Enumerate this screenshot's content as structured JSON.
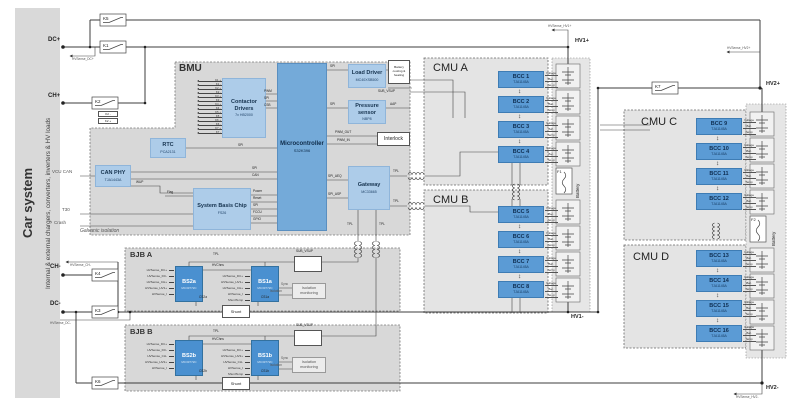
{
  "sidebar": {
    "title": "Car system",
    "subtitle": "Internal & external chargers, converters, inverters & HV loads"
  },
  "rails": {
    "dc_plus": "DC+",
    "ch_plus": "CH+",
    "ch_minus": "CH-",
    "dc_minus": "DC-",
    "hv1_plus": "HV1+",
    "hv1_minus": "HV1-",
    "hv2_plus": "HV2+",
    "hv2_minus": "HV2-"
  },
  "sense": {
    "dc_plus": "HVSense_DC+",
    "ch_minus": "HVSense_CH-",
    "dc_minus": "HVSense_DC-",
    "hv1_plus": "HVSense_HV1+",
    "hv2_plus": "HVSense_HV2+",
    "hv2_minus": "HVSense_HV2-"
  },
  "contactors": {
    "k1": "K1",
    "k2": "K2",
    "k2_minus": "K2 -",
    "k2_plus": "K2 +",
    "k3": "K3",
    "k4": "K4",
    "k5": "K5",
    "k6": "K6",
    "k7": "K7"
  },
  "signals": {
    "spi": "SPI",
    "can": "CAN",
    "pwm": "PWM",
    "csb": "CSB",
    "wup": "WUP",
    "flag": "Flag",
    "power": "Power",
    "reset": "Reset",
    "fccu": "FCCU",
    "gpio": "GPIO",
    "pwm_out": "PWM_OUT",
    "pwm_in": "PWM_IN",
    "spi_aeq": "SPI_AEQ",
    "spi_asp": "SPI_ASP",
    "tpl": "TPL",
    "sub_vsup": "SUB_VSUP",
    "aap": "AAP",
    "vcu_can": "VCU CAN",
    "t30": "T30",
    "crash": "Crash",
    "hvchns": "HVChns",
    "sync": "Sync",
    "isolation": "Isolation"
  },
  "bmu": {
    "label": "BMU",
    "galvanic": "Galvanic isolation",
    "contactor_drivers": {
      "title": "Contactor Drivers",
      "part": "7x HB2000",
      "pins": [
        "K1 +",
        "K1 -",
        "K2 +",
        "K2 -",
        "K3 +",
        "K3 -",
        "K4 +",
        "K4 -",
        "K5 +",
        "K5 -",
        "K6 +",
        "K6 -",
        "K7 +",
        "K7 -"
      ]
    },
    "mcu": {
      "title": "Microcontroller",
      "part": "S32K396"
    },
    "rtc": {
      "title": "RTC",
      "part": "PCA2131"
    },
    "can_phy": {
      "title": "CAN PHY",
      "part": "TJA1443A"
    },
    "sbc": {
      "title": "System Basis Chip",
      "part": "FS26"
    },
    "load_driver": {
      "title": "Load Driver",
      "part": "MC40XSB500"
    },
    "cooling": "Battery cooling & heating",
    "pressure": {
      "title": "Pressure sensor",
      "part": "NBP8"
    },
    "interlock": "Interlock",
    "gateway": {
      "title": "Gateway",
      "part": "MC33665"
    }
  },
  "bcc_signals": [
    "Voltage",
    "Bal.",
    "Temp"
  ],
  "cmus": {
    "a": {
      "label": "CMU A",
      "bccs": [
        {
          "name": "BCC 1",
          "part": "TJA1145A"
        },
        {
          "name": "BCC 2",
          "part": "TJA1145A"
        },
        {
          "name": "BCC 3",
          "part": "TJA1145A"
        },
        {
          "name": "BCC 4",
          "part": "TJA1145A"
        }
      ]
    },
    "b": {
      "label": "CMU B",
      "bccs": [
        {
          "name": "BCC 5",
          "part": "TJA1145A"
        },
        {
          "name": "BCC 6",
          "part": "TJA1145A"
        },
        {
          "name": "BCC 7",
          "part": "TJA1145A"
        },
        {
          "name": "BCC 8",
          "part": "TJA1145A"
        }
      ]
    },
    "c": {
      "label": "CMU C",
      "bccs": [
        {
          "name": "BCC 9",
          "part": "TJA1145A"
        },
        {
          "name": "BCC 10",
          "part": "TJA1145A"
        },
        {
          "name": "BCC 11",
          "part": "TJA1145A"
        },
        {
          "name": "BCC 12",
          "part": "TJA1145A"
        }
      ]
    },
    "d": {
      "label": "CMU D",
      "bccs": [
        {
          "name": "BCC 13",
          "part": "TJA1145A"
        },
        {
          "name": "BCC 14",
          "part": "TJA1145A"
        },
        {
          "name": "BCC 15",
          "part": "TJA1145A"
        },
        {
          "name": "BCC 16",
          "part": "TJA1145A"
        }
      ]
    }
  },
  "battery": {
    "label": "Battery",
    "f1": "F1",
    "f2": "F2"
  },
  "bjb_a": {
    "label": "BJB A",
    "bs2": {
      "name": "BS2a",
      "part": "MC33772C"
    },
    "bs1": {
      "name": "BS1a",
      "part": "MC33772C"
    },
    "bs2_inputs": [
      "HVSense_DC+",
      "HVSense_DC-",
      "HVSense_CH+",
      "HVSense_HV1+",
      "HVSense_I"
    ],
    "bs1_inputs": [
      "HVSense_DC+",
      "HVSense_HV1+",
      "HVSense_CH+",
      "HVSense_I",
      "ShuntTemp"
    ],
    "cs2": "CS2a",
    "cs1": "CS1a",
    "shunt": "Shunt",
    "iso_box": "Isolation monitoring"
  },
  "bjb_b": {
    "label": "BJB B",
    "bs2": {
      "name": "BS2b",
      "part": "MC33772C"
    },
    "bs1": {
      "name": "BS1b",
      "part": "MC33772C"
    },
    "bs2_inputs": [
      "HVSense_DC+",
      "HVSense_DC-",
      "HVSense_CH-",
      "HVSense_HV2+",
      "HVSense_I"
    ],
    "bs1_inputs": [
      "HVSense_DC+",
      "HVSense_HV2+",
      "HVSense_CH-",
      "HVSense_I",
      "ShuntTemp"
    ],
    "cs2": "CS2b",
    "cs1": "CS1b",
    "shunt": "Shunt",
    "iso_box": "Isolation monitoring"
  }
}
